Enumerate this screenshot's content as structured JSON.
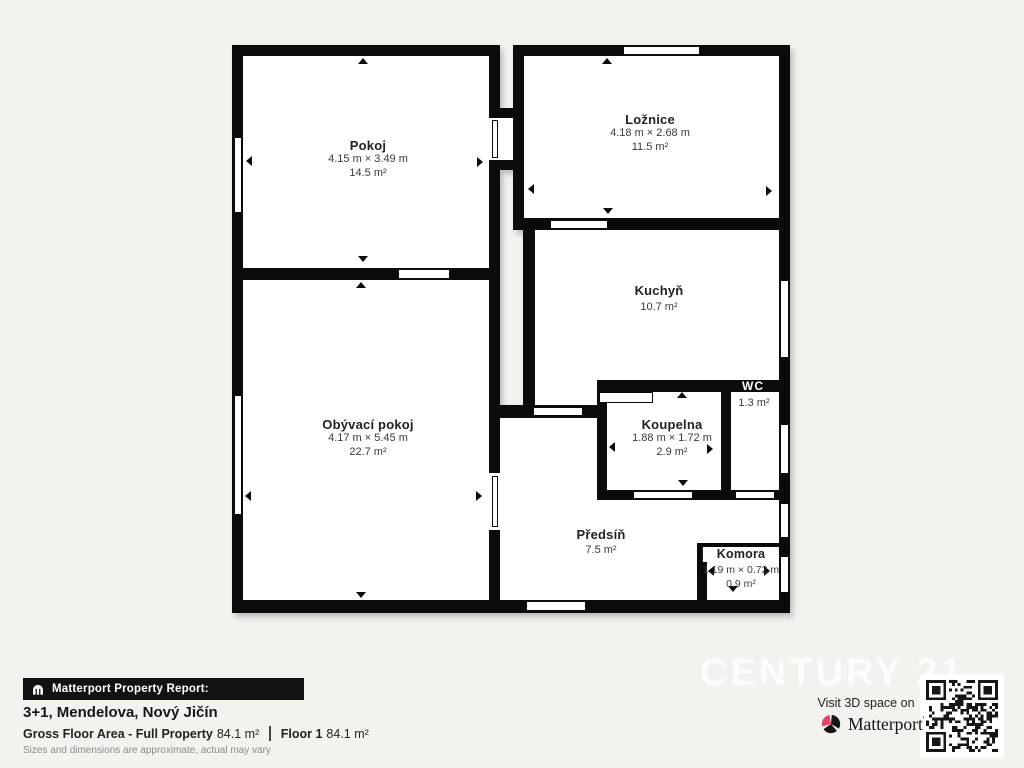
{
  "plan": {
    "rooms": [
      {
        "id": "pokoj",
        "name": "Pokoj",
        "dims": "4.15 m × 3.49 m",
        "area": "14.5 m²"
      },
      {
        "id": "loznice",
        "name": "Ložnice",
        "dims": "4.18 m × 2.68 m",
        "area": "11.5 m²"
      },
      {
        "id": "kuchyn",
        "name": "Kuchyň",
        "area": "10.7 m²"
      },
      {
        "id": "wc",
        "name": "WC",
        "area": "1.3 m²"
      },
      {
        "id": "koupelna",
        "name": "Koupelna",
        "dims": "1.88 m × 1.72 m",
        "area": "2.9 m²"
      },
      {
        "id": "obyvaci",
        "name": "Obývací pokoj",
        "dims": "4.17 m × 5.45 m",
        "area": "22.7 m²"
      },
      {
        "id": "predsin",
        "name": "Předsíň",
        "area": "7.5 m²"
      },
      {
        "id": "komora",
        "name": "Komora",
        "dims": "1.19 m × 0.72 m",
        "area": "0.9 m²"
      }
    ]
  },
  "footer": {
    "report_label": "Matterport Property Report:",
    "title": "3+1, Mendelova, Nový Jičín",
    "gross_label": "Gross Floor Area - Full Property",
    "gross_value": "84.1 m²",
    "floor_label": "Floor 1",
    "floor_value": "84.1 m²",
    "disclaimer": "Sizes and dimensions are approximate, actual may vary"
  },
  "branding": {
    "visit_text": "Visit 3D space on",
    "logo_text": "Matterport",
    "watermark": "CENTURY 21"
  },
  "colors": {
    "background": "#f4f2ef",
    "wall": "#0b0b0b",
    "room_fill": "#ffffff",
    "logo_pink": "#e8416b"
  }
}
